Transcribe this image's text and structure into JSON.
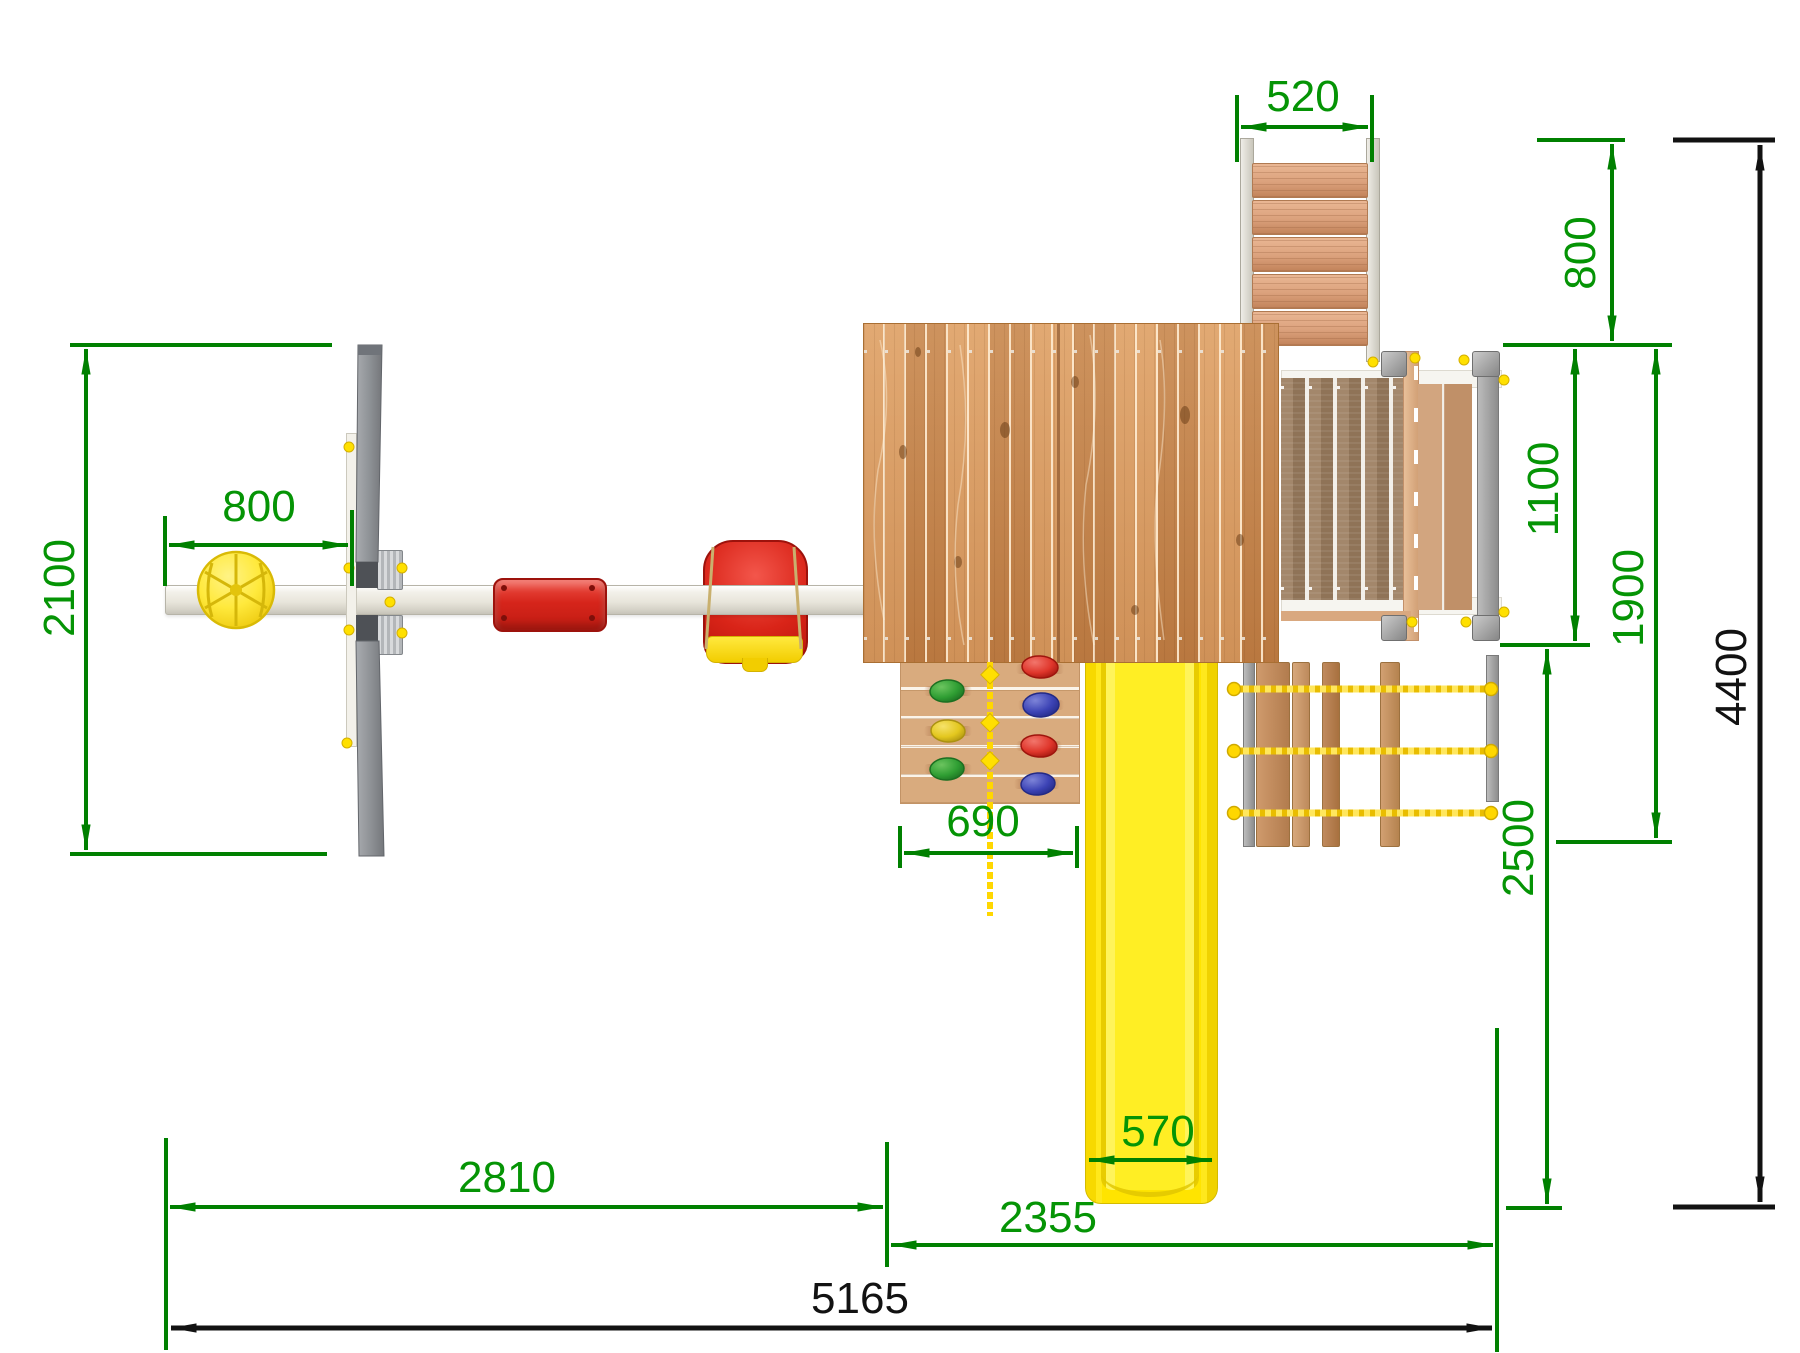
{
  "meta": {
    "type": "technical drawing",
    "subject": "playground set top (plan) view with overall dimensions",
    "units": "mm"
  },
  "colors": {
    "dimension_green": "#008000",
    "dimension_black": "#121212",
    "slide_yellow": "#ffe400",
    "rope_yellow": "#ffd700",
    "roof_wood": "#cd8a4e",
    "deck_wood": "#a3876b",
    "seat_red": "#d6251b",
    "frame_gray": "#8d9093",
    "beam_white": "#f3f1ea"
  },
  "dims": {
    "ladder_top_width": "520",
    "ladder_depth": "800",
    "deck_depth": "1100",
    "deck_net_depth": "1900",
    "slide_clearance": "2500",
    "total_depth": "4400",
    "swing_frame_depth": "2100",
    "beam_overhang": "800",
    "climb_wall_width": "690",
    "slide_width": "570",
    "swing_section_length": "2810",
    "tower_section_length": "2355",
    "total_length": "5165"
  }
}
